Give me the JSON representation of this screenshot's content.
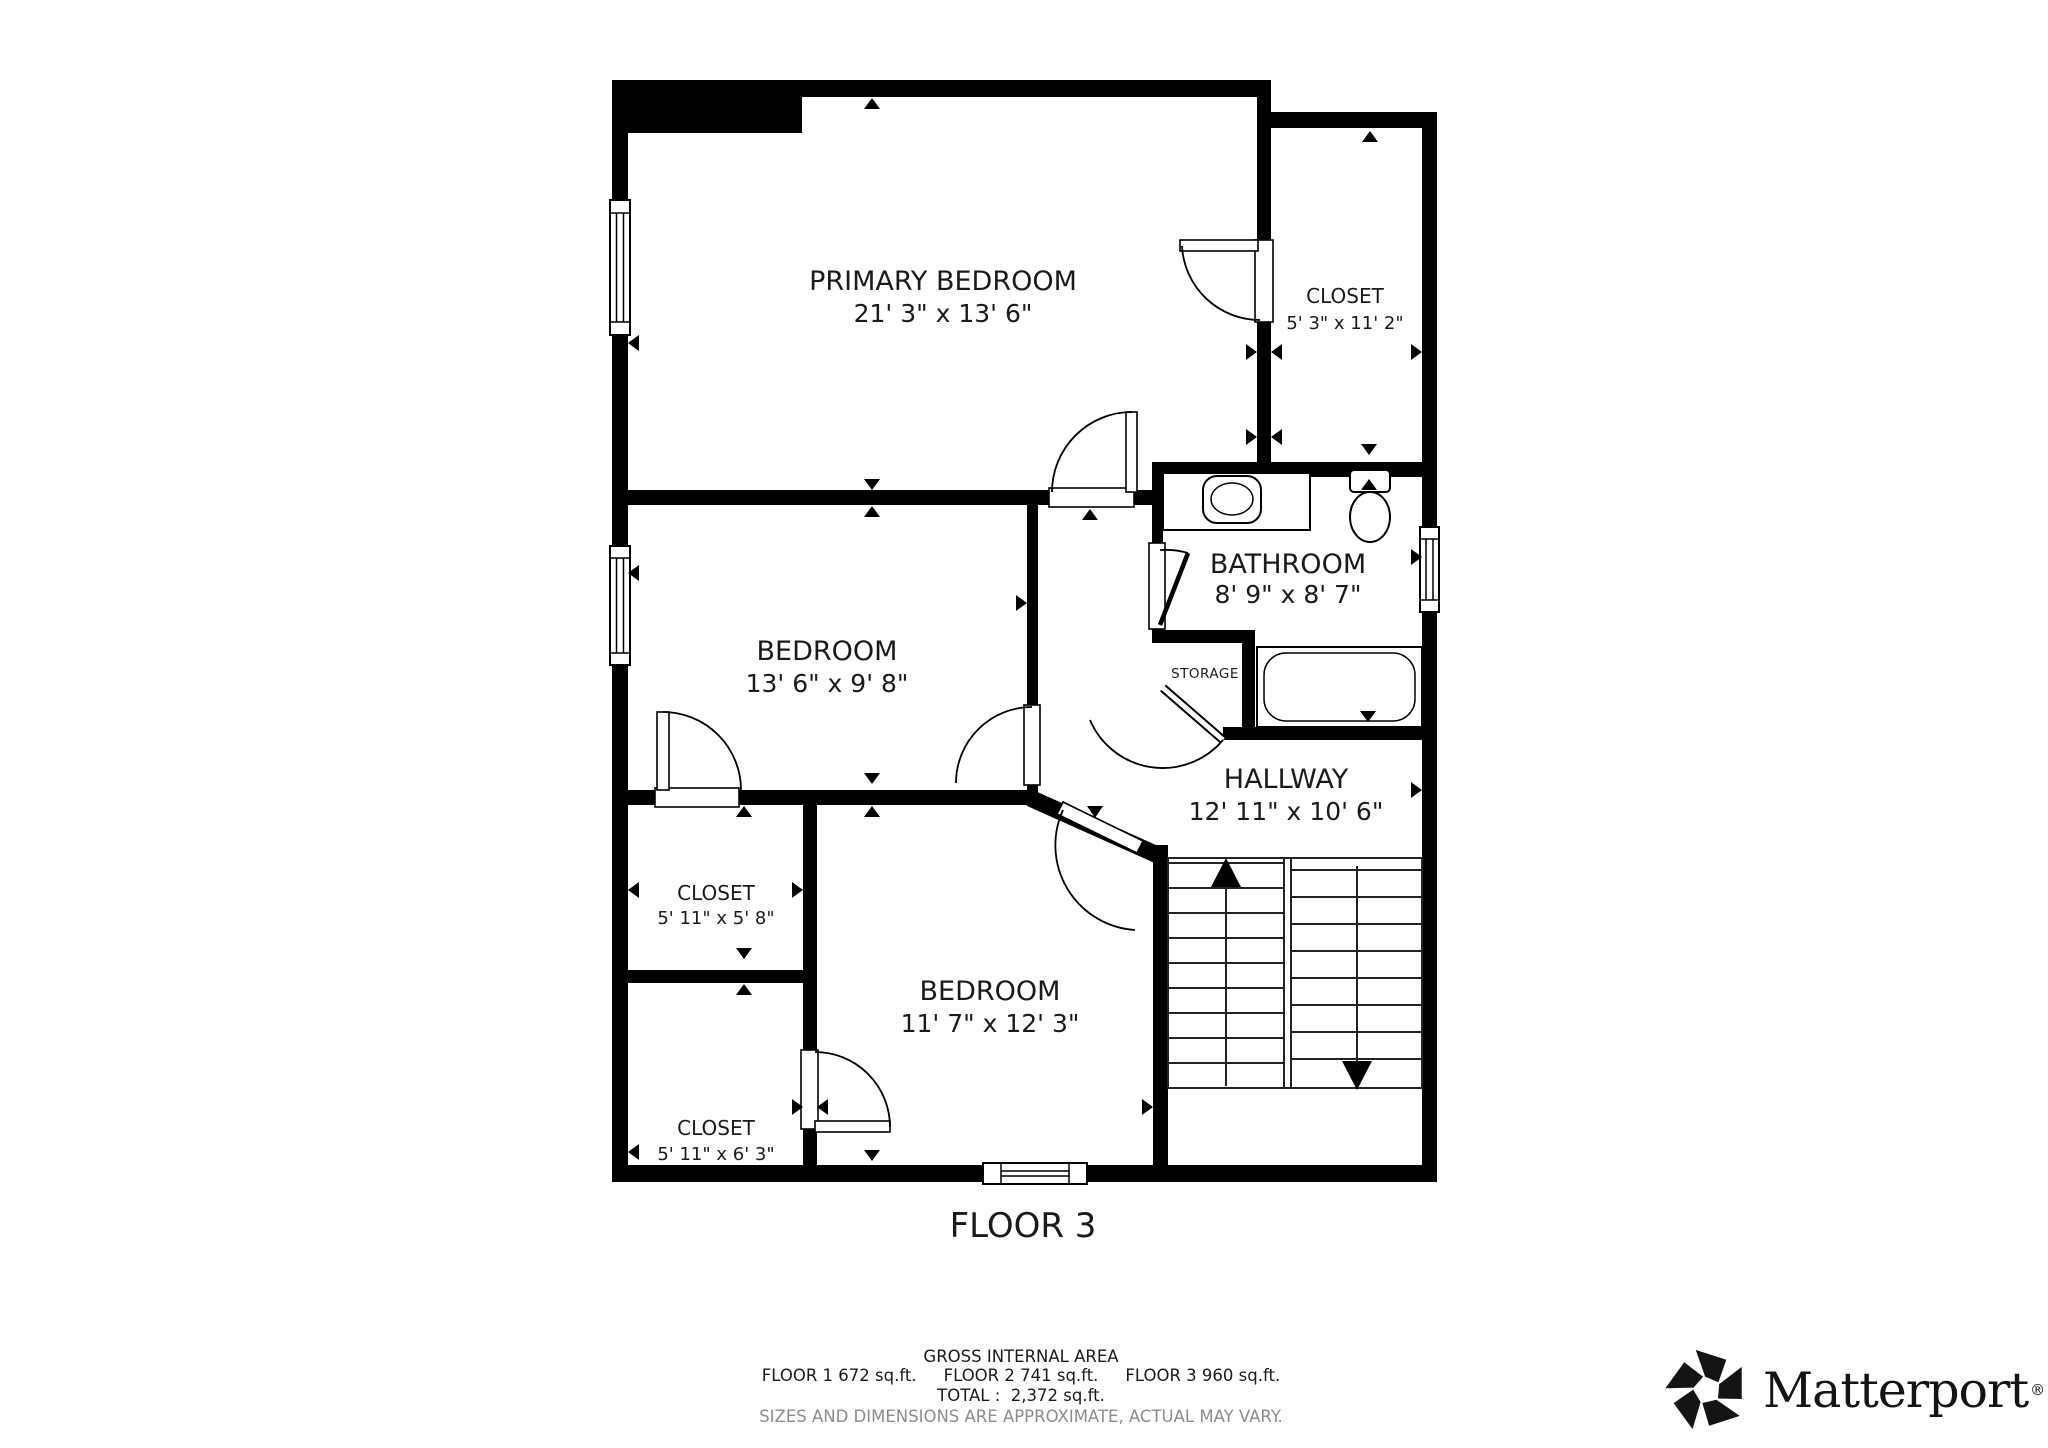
{
  "plan": {
    "floor_title": "FLOOR 3",
    "rooms": [
      {
        "id": "primary-bedroom",
        "name": "PRIMARY BEDROOM",
        "dims": "21' 3\" x 13' 6\""
      },
      {
        "id": "closet-top-right",
        "name": "CLOSET",
        "dims": "5' 3\" x 11' 2\""
      },
      {
        "id": "bathroom",
        "name": "BATHROOM",
        "dims": "8' 9\" x 8' 7\""
      },
      {
        "id": "storage",
        "name": "STORAGE",
        "dims": ""
      },
      {
        "id": "bedroom-middle",
        "name": "BEDROOM",
        "dims": "13' 6\" x 9' 8\""
      },
      {
        "id": "hallway",
        "name": "HALLWAY",
        "dims": "12' 11\" x 10' 6\""
      },
      {
        "id": "closet-left-upper",
        "name": "CLOSET",
        "dims": "5' 11\" x 5' 8\""
      },
      {
        "id": "bedroom-bottom",
        "name": "BEDROOM",
        "dims": "11' 7\" x 12' 3\""
      },
      {
        "id": "closet-left-lower",
        "name": "CLOSET",
        "dims": "5' 11\" x 6' 3\""
      }
    ]
  },
  "footer": {
    "area_title": "GROSS INTERNAL AREA",
    "floor_areas": [
      "FLOOR 1 672 sq.ft.",
      "FLOOR 2 741 sq.ft.",
      "FLOOR 3 960 sq.ft."
    ],
    "total": "TOTAL :  2,372 sq.ft.",
    "disclaimer": "SIZES AND DIMENSIONS ARE APPROXIMATE, ACTUAL MAY VARY."
  },
  "branding": {
    "logo_text": "Matterport",
    "registered_mark": "®"
  },
  "colors": {
    "wall": "#000000",
    "text": "#1a1a1a",
    "disclaimer_text": "#8c8c8c",
    "background": "#ffffff"
  }
}
